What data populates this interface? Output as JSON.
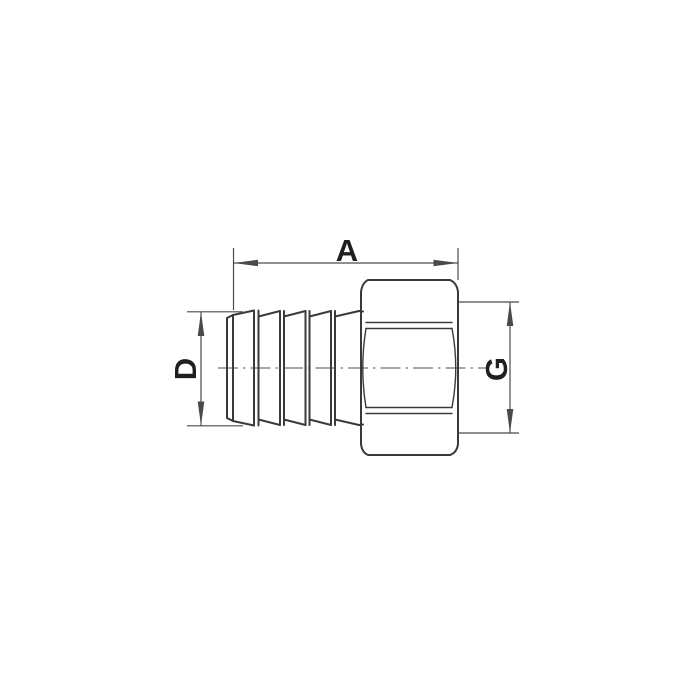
{
  "drawing": {
    "kind": "technical-dimension-drawing",
    "dimensions": {
      "a": {
        "label": "A"
      },
      "d": {
        "label": "D"
      },
      "g": {
        "label": "G"
      }
    }
  },
  "colors": {
    "background": "#ffffff",
    "outline": "#3a3a3a",
    "dimension": "#4a4a4a",
    "centerline": "#8c8c8c",
    "label": "#1f1f1f"
  }
}
